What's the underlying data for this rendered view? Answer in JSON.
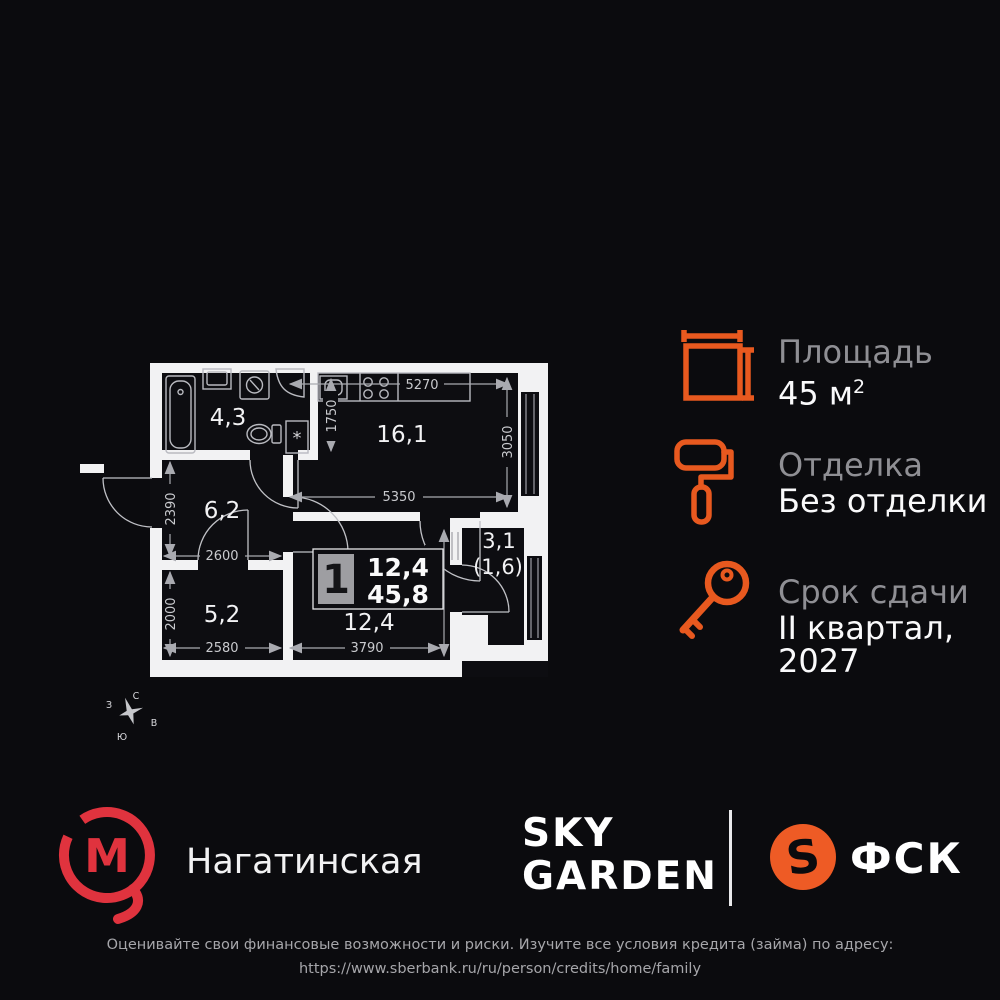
{
  "theme": {
    "background": "#0B0B0E",
    "accent_orange": "#E8591F",
    "metro_red": "#E0333E",
    "fsk_orange": "#EE5B25",
    "label_gray": "#8F8F94",
    "wall_white": "#F2F2F3"
  },
  "floorplan": {
    "rooms": [
      {
        "id": "bathroom",
        "area": "4,3"
      },
      {
        "id": "kitchen-living",
        "area": "16,1"
      },
      {
        "id": "hallway",
        "area": "6,2"
      },
      {
        "id": "bedroom",
        "area": "5,2"
      },
      {
        "id": "room",
        "area": "12,4"
      },
      {
        "id": "balcony",
        "area": "3,1",
        "area_coef": "(1,6)"
      }
    ],
    "dims": {
      "top": "5270",
      "bath_side": "1750",
      "right": "3050",
      "mid": "5350",
      "hall_v": "2390",
      "hall_h": "2600",
      "bed_v": "2000",
      "bed_h": "2580",
      "room_v": "3320",
      "room_h": "3790"
    },
    "badge": {
      "rooms": "1",
      "area_living": "12,4",
      "area_total": "45,8"
    },
    "closet_mark": "*",
    "compass": {
      "n": "С",
      "e": "В",
      "s": "Ю",
      "w": "З"
    }
  },
  "info": {
    "area": {
      "label": "Площадь",
      "value": "45 м",
      "value_sup": "2"
    },
    "finish": {
      "label": "Отделка",
      "value": "Без отделки"
    },
    "deadline": {
      "label": "Срок сдачи",
      "value_line1": "II квартал,",
      "value_line2": "2027"
    }
  },
  "brands": {
    "metro": {
      "letter": "М",
      "station": "Нагатинская"
    },
    "project": {
      "line1": "SKY",
      "line2": "GARDEN"
    },
    "developer": {
      "mark": "S",
      "name": "ФСК"
    }
  },
  "disclaimer": {
    "line1": "Оценивайте свои финансовые возможности и риски. Изучите все условия кредита (займа) по адресу:",
    "line2": "https://www.sberbank.ru/ru/person/credits/home/family"
  }
}
